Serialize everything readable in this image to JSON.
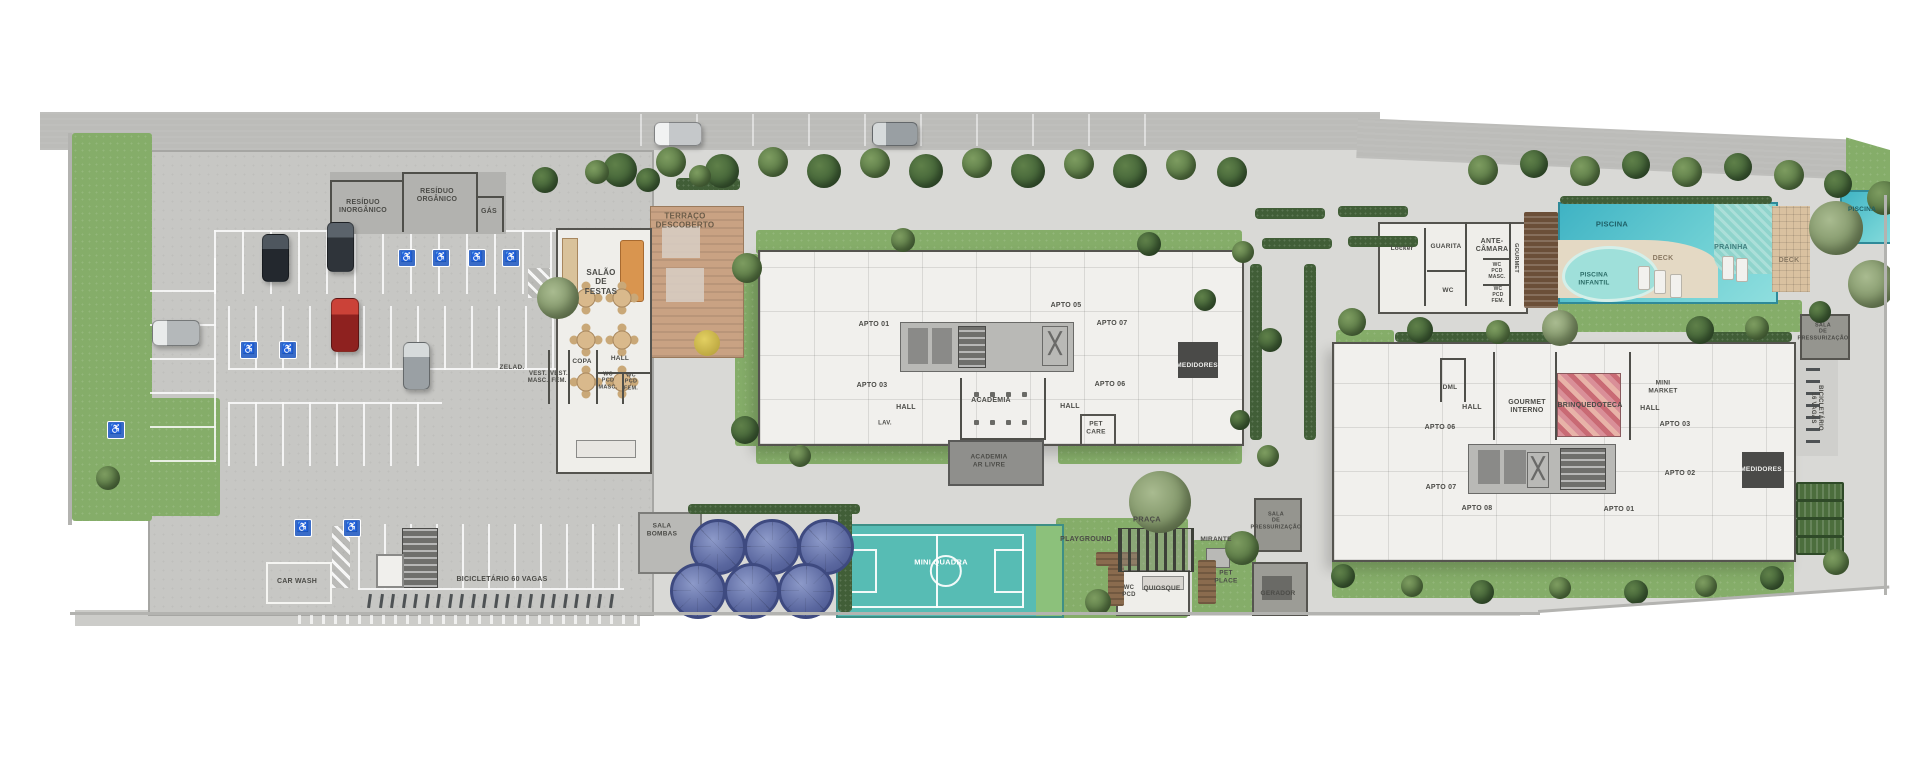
{
  "plan": {
    "title": "Implantação - planta do condomínio",
    "colors": {
      "lawn": "#85ad69",
      "road": "#bcbcb9",
      "garage": "#c7c7c4",
      "plaza": "#d9d9d6",
      "building": "#f1f0ed",
      "wall": "#4f4f4a",
      "pool": "#3fb3c4",
      "tank": "#5a679f",
      "accessible_blue": "#3a6cc8",
      "court": "#57bcb4",
      "wood": "#8a6b4e",
      "label_text": "#4b4b47"
    },
    "labels": [
      {
        "t": "RESÍDUO\nINORGÂNICO",
        "x": 363,
        "y": 207
      },
      {
        "t": "RESÍDUO\nORGÂNICO",
        "x": 437,
        "y": 196
      },
      {
        "t": "GÁS",
        "x": 489,
        "y": 212
      },
      {
        "t": "TERRAÇO\nDESCOBERTO",
        "x": 685,
        "y": 221,
        "fs": 8,
        "c": "#6b5c49"
      },
      {
        "t": "SALÃO\nDE\nFESTAS",
        "x": 601,
        "y": 282,
        "fs": 8
      },
      {
        "t": "ZELAD.",
        "x": 512,
        "y": 368,
        "fs": 6.5
      },
      {
        "t": "VEST.\nMASC.",
        "x": 538,
        "y": 378,
        "fs": 6
      },
      {
        "t": "VEST.\nFEM.",
        "x": 559,
        "y": 378,
        "fs": 6
      },
      {
        "t": "COPA",
        "x": 582,
        "y": 362,
        "fs": 6.5
      },
      {
        "t": "HALL",
        "x": 620,
        "y": 359,
        "fs": 6.5
      },
      {
        "t": "WC\nPCD\nMASC.",
        "x": 608,
        "y": 381,
        "fs": 5.5
      },
      {
        "t": "WC\nPCD\nFEM.",
        "x": 631,
        "y": 382,
        "fs": 5.5
      },
      {
        "t": "CAR WASH",
        "x": 297,
        "y": 582,
        "fs": 7
      },
      {
        "t": "BICICLETÁRIO 60 VAGAS",
        "x": 502,
        "y": 580,
        "fs": 7
      },
      {
        "t": "SALA\nBOMBAS",
        "x": 662,
        "y": 530,
        "fs": 6.5
      },
      {
        "t": "APTO 01",
        "x": 874,
        "y": 325
      },
      {
        "t": "APTO 03",
        "x": 872,
        "y": 386
      },
      {
        "t": "APTO 05",
        "x": 1066,
        "y": 306
      },
      {
        "t": "APTO 07",
        "x": 1112,
        "y": 324
      },
      {
        "t": "APTO 06",
        "x": 1110,
        "y": 385
      },
      {
        "t": "HALL",
        "x": 906,
        "y": 408,
        "fs": 7
      },
      {
        "t": "LAV.",
        "x": 885,
        "y": 424,
        "fs": 6
      },
      {
        "t": "ACADEMIA",
        "x": 991,
        "y": 401,
        "fs": 7
      },
      {
        "t": "ACADEMIA\nAR LIVRE",
        "x": 989,
        "y": 461,
        "fs": 6.5
      },
      {
        "t": "MEDIDORES",
        "x": 1197,
        "y": 366,
        "fs": 6.5,
        "c": "#f0f0ee"
      },
      {
        "t": "HALL",
        "x": 1070,
        "y": 407,
        "fs": 7
      },
      {
        "t": "PET\nCARE",
        "x": 1096,
        "y": 428,
        "fs": 6.5
      },
      {
        "t": "MINI QUADRA",
        "x": 941,
        "y": 563,
        "fs": 7.5,
        "c": "#ffffff"
      },
      {
        "t": "PLAYGROUND",
        "x": 1086,
        "y": 540,
        "fs": 7
      },
      {
        "t": "PRAÇA",
        "x": 1147,
        "y": 520,
        "fs": 7.5
      },
      {
        "t": "WC\nPCD",
        "x": 1129,
        "y": 592,
        "fs": 6
      },
      {
        "t": "QUIOSQUE",
        "x": 1162,
        "y": 589,
        "fs": 6.5
      },
      {
        "t": "PET\nPLACE",
        "x": 1226,
        "y": 577,
        "fs": 6.5
      },
      {
        "t": "MIRANTE",
        "x": 1216,
        "y": 540,
        "fs": 6.5
      },
      {
        "t": "SALA\nDE\nPRESSURIZAÇÃO",
        "x": 1276,
        "y": 521,
        "fs": 5.5
      },
      {
        "t": "GERADOR",
        "x": 1278,
        "y": 594,
        "fs": 6.5
      },
      {
        "t": "DML",
        "x": 1450,
        "y": 388,
        "fs": 6.5
      },
      {
        "t": "HALL",
        "x": 1472,
        "y": 408,
        "fs": 7
      },
      {
        "t": "GOURMET\nINTERNO",
        "x": 1527,
        "y": 407,
        "fs": 7
      },
      {
        "t": "BRINQUEDOTECA",
        "x": 1590,
        "y": 406,
        "fs": 7
      },
      {
        "t": "HALL",
        "x": 1650,
        "y": 409,
        "fs": 7
      },
      {
        "t": "MINI\nMARKET",
        "x": 1663,
        "y": 387,
        "fs": 6.5
      },
      {
        "t": "APTO 06",
        "x": 1440,
        "y": 428
      },
      {
        "t": "APTO 07",
        "x": 1441,
        "y": 488
      },
      {
        "t": "APTO 08",
        "x": 1477,
        "y": 509
      },
      {
        "t": "APTO 01",
        "x": 1619,
        "y": 510
      },
      {
        "t": "APTO 03",
        "x": 1675,
        "y": 425
      },
      {
        "t": "APTO 02",
        "x": 1680,
        "y": 474
      },
      {
        "t": "MEDIDORES",
        "x": 1761,
        "y": 470,
        "fs": 6.5,
        "c": "#f0f0ee"
      },
      {
        "t": "SALA\nDE\nPRESSURIZAÇÃO",
        "x": 1823,
        "y": 332,
        "fs": 5.5
      },
      {
        "t": "BICICLETÁRIO\n16 VAGAS",
        "x": 1816,
        "y": 408,
        "fs": 6,
        "rot": 90
      },
      {
        "t": "Locker",
        "x": 1402,
        "y": 249,
        "fs": 6.5
      },
      {
        "t": "GUARITA",
        "x": 1446,
        "y": 247,
        "fs": 6.5
      },
      {
        "t": "ANTE-\nCÂMARA",
        "x": 1492,
        "y": 246,
        "fs": 7
      },
      {
        "t": "WC",
        "x": 1448,
        "y": 291,
        "fs": 6.5
      },
      {
        "t": "GOURMET",
        "x": 1516,
        "y": 258,
        "fs": 5.5,
        "rot": 90
      },
      {
        "t": "WC\nPCD\nMASC.",
        "x": 1497,
        "y": 272,
        "fs": 5
      },
      {
        "t": "WC\nPCD\nFEM.",
        "x": 1498,
        "y": 296,
        "fs": 5
      },
      {
        "t": "PISCINA",
        "x": 1612,
        "y": 225,
        "fs": 7.5,
        "c": "#1e5f66"
      },
      {
        "t": "PISCINA",
        "x": 1862,
        "y": 210,
        "fs": 6.5,
        "c": "#1e5f66"
      },
      {
        "t": "PISCINA\nINFANTIL",
        "x": 1594,
        "y": 279,
        "fs": 6.5,
        "c": "#2a6b66"
      },
      {
        "t": "DECK",
        "x": 1663,
        "y": 259,
        "fs": 7,
        "c": "#8a7a64"
      },
      {
        "t": "PRAINHA",
        "x": 1731,
        "y": 248,
        "fs": 7,
        "c": "#3f7d7d"
      },
      {
        "t": "DECK",
        "x": 1789,
        "y": 261,
        "fs": 7,
        "c": "#8a7a64"
      }
    ],
    "trees": [
      [
        620,
        170,
        34,
        0
      ],
      [
        671,
        162,
        30,
        1
      ],
      [
        722,
        171,
        34,
        0
      ],
      [
        773,
        162,
        30,
        1
      ],
      [
        824,
        171,
        34,
        0
      ],
      [
        875,
        163,
        30,
        1
      ],
      [
        926,
        171,
        34,
        0
      ],
      [
        977,
        163,
        30,
        1
      ],
      [
        1028,
        171,
        34,
        0
      ],
      [
        1079,
        164,
        30,
        1
      ],
      [
        1130,
        171,
        34,
        0
      ],
      [
        1181,
        165,
        30,
        1
      ],
      [
        1232,
        172,
        30,
        0
      ],
      [
        1483,
        170,
        30,
        1
      ],
      [
        1534,
        164,
        28,
        0
      ],
      [
        1585,
        171,
        30,
        1
      ],
      [
        1636,
        165,
        28,
        0
      ],
      [
        1687,
        172,
        30,
        1
      ],
      [
        1738,
        167,
        28,
        0
      ],
      [
        1789,
        175,
        30,
        1
      ],
      [
        1838,
        184,
        28,
        0
      ],
      [
        558,
        298,
        42,
        2
      ],
      [
        545,
        180,
        26,
        0
      ],
      [
        597,
        172,
        24,
        1
      ],
      [
        648,
        180,
        24,
        0
      ],
      [
        700,
        176,
        22,
        1
      ],
      [
        747,
        268,
        30,
        1
      ],
      [
        745,
        430,
        28,
        0
      ],
      [
        903,
        240,
        24,
        1
      ],
      [
        1149,
        244,
        24,
        0
      ],
      [
        800,
        456,
        22,
        1
      ],
      [
        1205,
        300,
        22,
        0
      ],
      [
        1243,
        252,
        22,
        1
      ],
      [
        1240,
        420,
        20,
        0
      ],
      [
        1270,
        340,
        24,
        0
      ],
      [
        1268,
        456,
        22,
        1
      ],
      [
        1160,
        502,
        62,
        2
      ],
      [
        1098,
        602,
        26,
        1
      ],
      [
        1242,
        548,
        34,
        1
      ],
      [
        1352,
        322,
        28,
        1
      ],
      [
        1420,
        330,
        26,
        0
      ],
      [
        1498,
        332,
        24,
        1
      ],
      [
        1560,
        328,
        36,
        2
      ],
      [
        1700,
        330,
        28,
        0
      ],
      [
        1757,
        328,
        24,
        1
      ],
      [
        1820,
        312,
        22,
        0
      ],
      [
        1343,
        576,
        24,
        0
      ],
      [
        1412,
        586,
        22,
        1
      ],
      [
        1482,
        592,
        24,
        0
      ],
      [
        1560,
        588,
        22,
        1
      ],
      [
        1636,
        592,
        24,
        0
      ],
      [
        1706,
        586,
        22,
        1
      ],
      [
        1772,
        578,
        24,
        0
      ],
      [
        1836,
        562,
        26,
        1
      ],
      [
        1836,
        228,
        54,
        2
      ],
      [
        1872,
        284,
        48,
        2
      ],
      [
        1884,
        198,
        34,
        1
      ],
      [
        108,
        478,
        24,
        1
      ]
    ],
    "tanks": [
      [
        718,
        547
      ],
      [
        772,
        547
      ],
      [
        826,
        547
      ],
      [
        698,
        591
      ],
      [
        752,
        591
      ],
      [
        806,
        591
      ]
    ],
    "access_icon": "♿",
    "access": [
      [
        407,
        258
      ],
      [
        441,
        258
      ],
      [
        477,
        258
      ],
      [
        511,
        258
      ],
      [
        249,
        350
      ],
      [
        288,
        350
      ],
      [
        303,
        528
      ],
      [
        352,
        528
      ],
      [
        116,
        430
      ]
    ],
    "cars": [
      [
        327,
        222,
        25,
        48,
        "#2f343a",
        "#5b636b"
      ],
      [
        262,
        234,
        25,
        46,
        "#23282e",
        "#4e565e"
      ],
      [
        331,
        298,
        26,
        52,
        "#8e211f",
        "#cb4238"
      ],
      [
        403,
        342,
        25,
        46,
        "#9aa0a4",
        "#d6dadb"
      ],
      [
        152,
        320,
        46,
        24,
        "#b4b8ba",
        "#e9ebeb"
      ],
      [
        654,
        122,
        46,
        22,
        "#c5c8ca",
        "#f1f2f2"
      ],
      [
        872,
        122,
        44,
        22,
        "#999fa3",
        "#d6dadb"
      ]
    ],
    "stall_rows": [
      {
        "x": 214,
        "y": 230,
        "w": 342,
        "h": 62,
        "g": 28,
        "dir": "v",
        "edge": "top",
        "op": 0.9
      },
      {
        "x": 150,
        "y": 258,
        "w": 64,
        "h": 204,
        "g": 34,
        "dir": "h",
        "edge": "right",
        "op": 0.9
      },
      {
        "x": 228,
        "y": 306,
        "w": 328,
        "h": 62,
        "g": 27,
        "dir": "v",
        "edge": "bottom",
        "op": 0.9
      },
      {
        "x": 228,
        "y": 402,
        "w": 214,
        "h": 62,
        "g": 27,
        "dir": "v",
        "edge": "top",
        "op": 0.9
      },
      {
        "x": 358,
        "y": 524,
        "w": 266,
        "h": 64,
        "g": 26,
        "dir": "v",
        "edge": "bottom",
        "op": 0.9
      },
      {
        "x": 640,
        "y": 114,
        "w": 560,
        "h": 32,
        "g": 56,
        "dir": "v",
        "edge": "none",
        "op": 0.55
      }
    ],
    "bikes": [
      {
        "x": 368,
        "y": 594,
        "n": 22,
        "g": 11.5,
        "vert": false
      },
      {
        "x": 1806,
        "y": 368,
        "n": 7,
        "g": 12,
        "vert": true
      }
    ],
    "patches": [
      [
        72,
        133,
        80,
        388
      ],
      [
        72,
        398,
        148,
        118
      ],
      [
        735,
        254,
        24,
        192
      ],
      [
        756,
        230,
        486,
        24
      ],
      [
        756,
        442,
        252,
        22
      ],
      [
        1058,
        442,
        184,
        22
      ],
      [
        1332,
        558,
        462,
        40
      ],
      [
        1336,
        330,
        58,
        104
      ],
      [
        1056,
        518,
        132,
        100
      ],
      [
        1192,
        540,
        64,
        74
      ],
      [
        1558,
        300,
        244,
        32
      ],
      [
        1846,
        136,
        62,
        74
      ]
    ],
    "shrubs": [
      [
        688,
        504,
        172,
        10
      ],
      [
        1250,
        264,
        12,
        176
      ],
      [
        1304,
        264,
        12,
        176
      ],
      [
        1255,
        208,
        70,
        11
      ],
      [
        1338,
        206,
        70,
        11
      ],
      [
        1262,
        238,
        70,
        11
      ],
      [
        1348,
        236,
        70,
        11
      ],
      [
        1560,
        196,
        212,
        8
      ],
      [
        838,
        508,
        14,
        104
      ],
      [
        1395,
        332,
        168,
        10
      ],
      [
        1700,
        332,
        92,
        10
      ],
      [
        676,
        178,
        64,
        12
      ]
    ],
    "beds": [
      [
        1796,
        482
      ],
      [
        1796,
        500
      ],
      [
        1796,
        518
      ],
      [
        1796,
        536
      ]
    ],
    "walls": [
      [
        1424,
        228,
        2,
        78
      ],
      [
        1465,
        222,
        2,
        84
      ],
      [
        1509,
        222,
        2,
        84
      ],
      [
        1427,
        270,
        40,
        2
      ],
      [
        1483,
        258,
        28,
        2
      ],
      [
        1483,
        284,
        28,
        2
      ],
      [
        1493,
        352,
        2,
        88
      ],
      [
        1555,
        352,
        2,
        88
      ],
      [
        1629,
        352,
        2,
        88
      ],
      [
        1440,
        358,
        26,
        2
      ],
      [
        1440,
        358,
        2,
        44
      ],
      [
        1464,
        358,
        2,
        44
      ],
      [
        960,
        378,
        2,
        62
      ],
      [
        1044,
        378,
        2,
        62
      ],
      [
        960,
        438,
        86,
        2
      ],
      [
        548,
        350,
        2,
        54
      ],
      [
        568,
        350,
        2,
        54
      ],
      [
        596,
        350,
        2,
        54
      ],
      [
        622,
        372,
        2,
        32
      ],
      [
        596,
        372,
        54,
        2
      ],
      [
        330,
        180,
        2,
        52
      ],
      [
        402,
        172,
        2,
        60
      ],
      [
        476,
        172,
        2,
        60
      ],
      [
        502,
        196,
        2,
        36
      ],
      [
        330,
        180,
        74,
        2
      ],
      [
        402,
        172,
        76,
        2
      ],
      [
        478,
        196,
        26,
        2
      ]
    ],
    "tables": [
      [
        586,
        298
      ],
      [
        622,
        298
      ],
      [
        586,
        340
      ],
      [
        622,
        340
      ],
      [
        586,
        382
      ],
      [
        622,
        382
      ]
    ],
    "gym_dots": [
      [
        974,
        392
      ],
      [
        990,
        392
      ],
      [
        1006,
        392
      ],
      [
        1022,
        392
      ],
      [
        974,
        420
      ],
      [
        990,
        420
      ],
      [
        1006,
        420
      ],
      [
        1022,
        420
      ]
    ],
    "loungers": [
      [
        1638,
        266
      ],
      [
        1654,
        270
      ],
      [
        1670,
        274
      ],
      [
        1722,
        256
      ],
      [
        1736,
        258
      ]
    ]
  }
}
